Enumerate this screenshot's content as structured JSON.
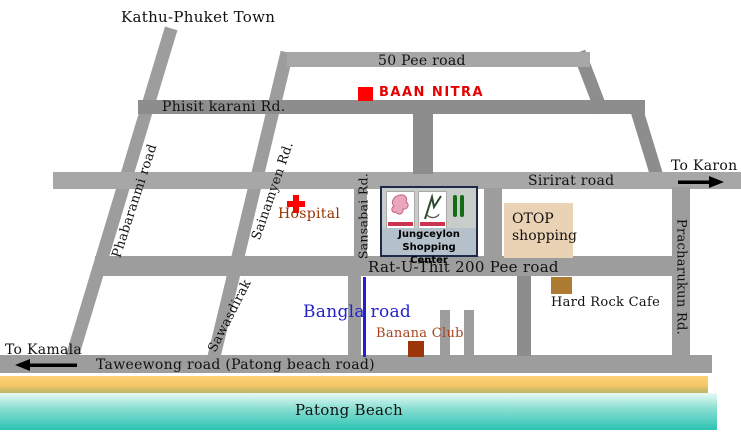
{
  "map": {
    "destinations": {
      "north": "Kathu-Phuket Town",
      "east": "To Karon",
      "west": "To Kamala"
    },
    "roads": {
      "fifty_pee": "50 Pee road",
      "phisit_karani": "Phisit karani Rd.",
      "sirirat": "Sirirat road",
      "rat_u_thit": "Rat-U-Thit 200 Pee road",
      "taweewong": "Taweewong road (Patong beach road)",
      "bangla": "Bangla road",
      "phabaranmi": "Phabaranmi road",
      "sainamyen": "Sainamyen Rd.",
      "sawasdirak": "Sawasdirak",
      "sansabai": "Sansabai Rd.",
      "pracharukun": "Pracharukun Rd."
    },
    "places": {
      "baan_nitra": "BAAN NITRA",
      "hospital": "Hospital",
      "jungceylon_l1": "Jungceylon",
      "jungceylon_l2": "Shopping Center",
      "otop_l1": "OTOP",
      "otop_l2": "shopping",
      "hard_rock": "Hard Rock Cafe",
      "banana_club": "Banana Club"
    },
    "beach": {
      "label": "Patong Beach"
    },
    "colors": {
      "accent_red": "#ff0000",
      "brand_red_text": "#e60000",
      "hospital_text": "#993300",
      "banana_text": "#a8431c",
      "bangla_blue": "#2222cc",
      "otop_bg": "#ead3b4",
      "hard_rock_marker": "#ad7b32",
      "banana_marker": "#9c3509",
      "caption_bg": "#b5c1ca",
      "road_gray": "#9d9d9d",
      "sand": "#f6c766",
      "sea_deep": "#2cc3b3"
    }
  }
}
